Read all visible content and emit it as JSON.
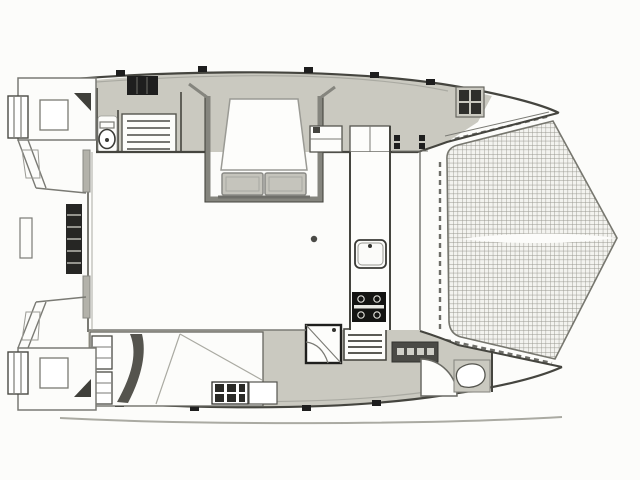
{
  "page": {
    "title": "Catamaran deck and interior floor plan drawing",
    "type": "boat-floor-plan",
    "view": "top-down plan view, bow to the right, sterns to the left"
  },
  "colors": {
    "paper": "#fcfcfa",
    "deck_fill": "#cac9c0",
    "cushion_fill": "#c5c4bc",
    "dark_fill": "#1e1e1e",
    "steps_fill": "#4a4a46",
    "tab_fill": "#b3b2aa",
    "line_dark": "#45453f",
    "line_mid": "#7a7a74",
    "line_light": "#aaaaa2",
    "tramp_line": "#98978f",
    "tramp_bg": "#f3f3ef",
    "shadow": "#dbdad4",
    "swoosh": "#55544e"
  },
  "features": [
    {
      "name": "port-hull",
      "label": "Port hull (top) with forward berth area"
    },
    {
      "name": "starboard-hull",
      "label": "Starboard hull (bottom) with aft cabin"
    },
    {
      "name": "saloon",
      "label": "Central saloon / bridgedeck"
    },
    {
      "name": "dinette",
      "label": "Dinette table with bench seat cushions"
    },
    {
      "name": "galley-sink",
      "label": "Galley sink with faucet"
    },
    {
      "name": "galley-stove",
      "label": "Galley stove with four burners"
    },
    {
      "name": "fridge-vent-unit",
      "label": "Slatted fridge / vent unit"
    },
    {
      "name": "port-companionway-steps",
      "label": "Port hull companionway steps"
    },
    {
      "name": "starboard-companionway-steps",
      "label": "Starboard hull companionway steps"
    },
    {
      "name": "heads-toilet",
      "label": "Port aft heads toilet"
    },
    {
      "name": "heads-counter",
      "label": "Slatted heads counter / berth"
    },
    {
      "name": "shower-pan",
      "label": "Shower compartment with pan"
    },
    {
      "name": "forepeak-wc",
      "label": "Starboard forepeak WC"
    },
    {
      "name": "wardrobe",
      "label": "Aft cabin wardrobe shelves"
    },
    {
      "name": "drawer-grid",
      "label": "Drawer / locker grid unit"
    },
    {
      "name": "cabin-door-arc",
      "label": "Cabin door swing arc"
    },
    {
      "name": "mast-post",
      "label": "Mast compression post mark"
    },
    {
      "name": "trampoline-net",
      "label": "Bow trampoline netting (two panels)"
    },
    {
      "name": "trampoline-seam",
      "label": "Central seam / bowsprit line between net panels"
    },
    {
      "name": "trampoline-lacing",
      "label": "Trampoline lacing (dashed) along hull edges"
    },
    {
      "name": "bow-tips",
      "label": "Port and starboard bow tips converging to forward apex"
    },
    {
      "name": "stern-platforms",
      "label": "Twin stern swim platforms with steps"
    },
    {
      "name": "boarding-ladder",
      "label": "Aft boarding ladder"
    },
    {
      "name": "cockpit",
      "label": "Aft cockpit between hulls"
    },
    {
      "name": "deck-hatches",
      "label": "Deck hatches and fittings along hull edges"
    }
  ]
}
